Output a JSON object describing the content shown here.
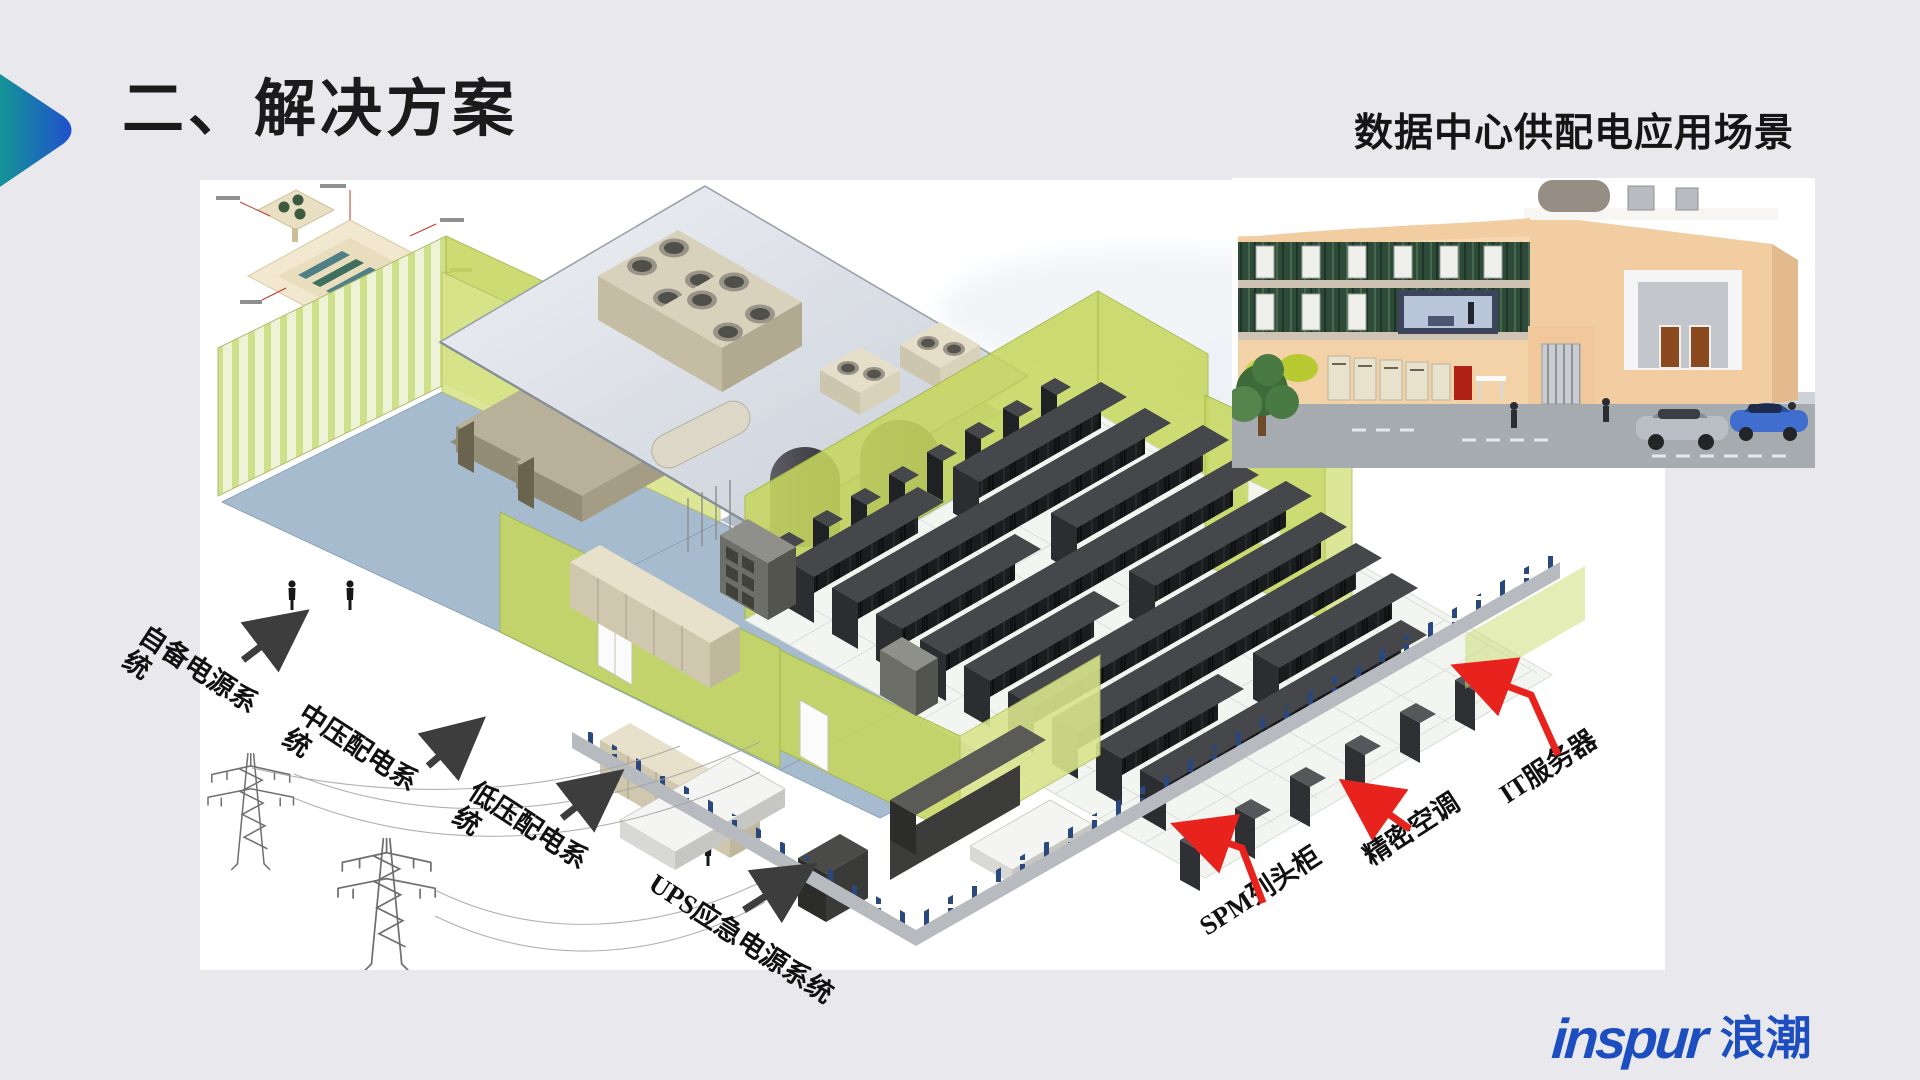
{
  "slide": {
    "title": "二、解决方案",
    "subtitle": "数据中心供配电应用场景",
    "background_color": "#e9e9ed",
    "accent_gradient": [
      "#12a08d",
      "#1f55c9"
    ]
  },
  "diagram": {
    "arrow_colors": {
      "black": "#3d3d3d",
      "red": "#e8231d"
    },
    "annotations": [
      {
        "id": "self-provided-power",
        "text_line1": "自备电源系",
        "text_line2": "统",
        "arrow": "black"
      },
      {
        "id": "mv-distribution",
        "text_line1": "中压配电系",
        "text_line2": "统",
        "arrow": "black"
      },
      {
        "id": "lv-distribution",
        "text_line1": "低压配电系",
        "text_line2": "统",
        "arrow": "black"
      },
      {
        "id": "ups-emergency-power",
        "text_line1": "UPS应急电源系统",
        "text_line2": "",
        "arrow": "black"
      },
      {
        "id": "spm-row-cabinet",
        "text_line1": "SPM列头柜",
        "text_line2": "",
        "arrow": "red"
      },
      {
        "id": "precision-ac",
        "text_line1": "精密空调",
        "text_line2": "",
        "arrow": "red"
      },
      {
        "id": "it-servers",
        "text_line1": "IT服务器",
        "text_line2": "",
        "arrow": "red"
      }
    ],
    "icons": [
      "cooling-tower-icon",
      "power-pylon-icon",
      "generator-icon",
      "transformer-tank-icon",
      "server-rack-rows-icon",
      "ups-cabinet-icon",
      "building-cutaway-icon"
    ]
  },
  "logo": {
    "latin": "inspur",
    "cjk": "浪潮",
    "color": "#1c4ec0"
  }
}
